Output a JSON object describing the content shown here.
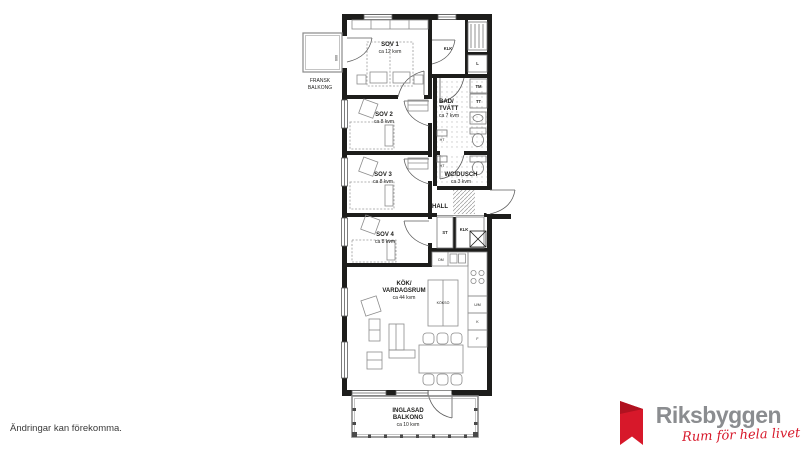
{
  "disclaimer": "Ändringar kan förekomma.",
  "brand": {
    "name": "Riksbyggen",
    "tagline": "Rum för hela livet",
    "red": "#d7182a",
    "gray": "#8b8d90"
  },
  "colors": {
    "wall": "#1d1d1b",
    "thin_line": "#6e6e6e",
    "background": "#ffffff"
  },
  "rooms": [
    {
      "label": "SOV 1",
      "area": "ca 12 kvm"
    },
    {
      "label": "SOV 2",
      "area": "ca 8 kvm"
    },
    {
      "label": "SOV 3",
      "area": "ca 8 kvm"
    },
    {
      "label": "SOV 4",
      "area": "ca 8 kvm"
    },
    {
      "label": "BAD/",
      "label2": "TVÄTT",
      "area": "ca 7 kvm"
    },
    {
      "label": "WC/DUSCH",
      "area": "ca 3 kvm"
    },
    {
      "label": "HALL"
    },
    {
      "label": "KÖK/",
      "label2": "VARDAGSRUM",
      "area": "ca 44 kvm"
    },
    {
      "label": "FRANSK",
      "label2": "BALKONG"
    },
    {
      "label": "INGLASAD",
      "label2": "BALKONG",
      "area": "ca 10 kvm"
    }
  ],
  "fixtures": {
    "klk_top": "KLK",
    "linen": "L",
    "tm": "TM",
    "tt": "TT",
    "ht_bad": "HT",
    "ht_wc": "HT",
    "st": "ST",
    "klk_hall": "KLK",
    "dm": "DM",
    "island": "KÖKSÖ",
    "oven_micro": "U/M",
    "fridge": "K",
    "freezer": "F",
    "balcony_door_dim": "600"
  }
}
